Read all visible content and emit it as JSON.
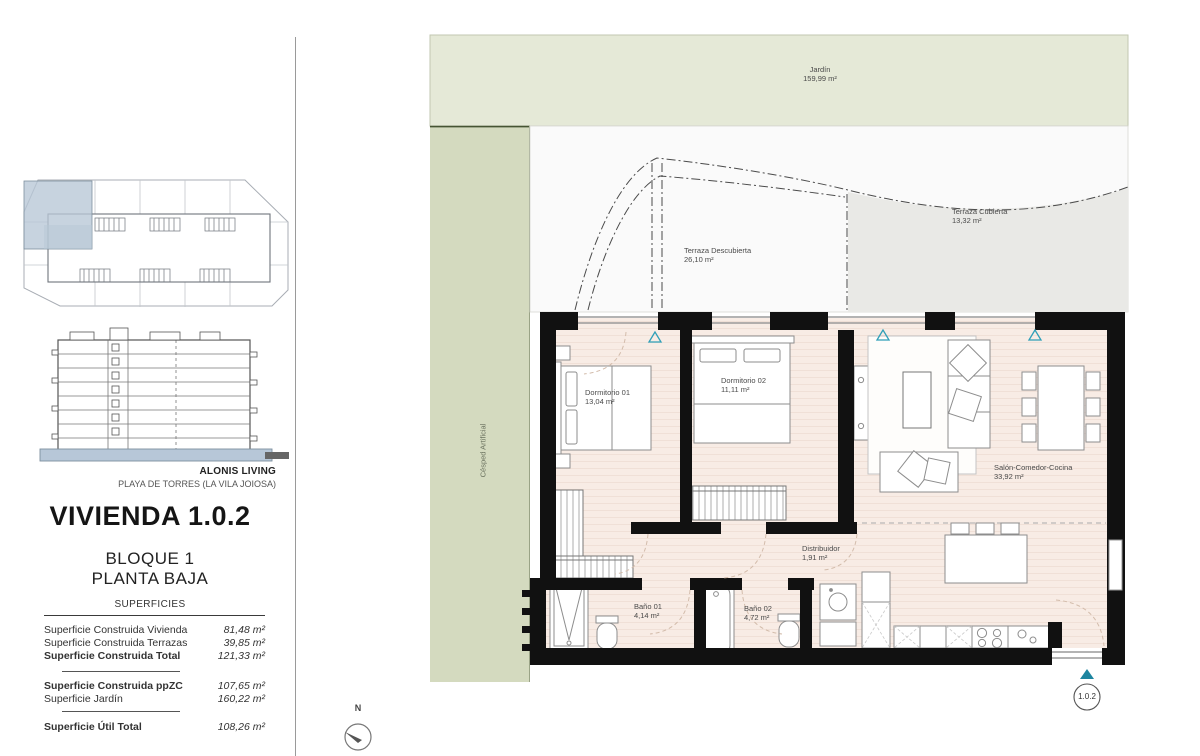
{
  "branding": {
    "name": "ALONIS LIVING",
    "location": "PLAYA DE TORRES (LA VILA JOIOSA)"
  },
  "unit": {
    "title": "VIVIENDA 1.0.2",
    "block": "BLOQUE 1",
    "floor": "PLANTA BAJA",
    "badge": "1.0.2"
  },
  "superficies": {
    "heading": "SUPERFICIES",
    "rows": [
      {
        "label": "Superficie Construida Vivienda",
        "value": "81,48 m²"
      },
      {
        "label": "Superficie Construida Terrazas",
        "value": "39,85 m²"
      },
      {
        "label": "Superficie Construida Total",
        "value": "121,33 m²"
      },
      {
        "label": "Superficie Construida ppZC",
        "value": "107,65 m²"
      },
      {
        "label": "Superficie Jardín",
        "value": "160,22 m²"
      },
      {
        "label": "Superficie Útil Total",
        "value": "108,26 m²"
      }
    ]
  },
  "plan": {
    "jardin": {
      "name": "Jardín",
      "area": "159,99 m²"
    },
    "cesped": {
      "name": "Césped Artificial"
    },
    "terraza_descubierta": {
      "name": "Terraza Descubierta",
      "area": "26,10 m²"
    },
    "terraza_cubierta": {
      "name": "Terraza Cubierta",
      "area": "13,32 m²"
    },
    "dormitorio_01": {
      "name": "Dormitorio 01",
      "area": "13,04 m²"
    },
    "dormitorio_02": {
      "name": "Dormitorio 02",
      "area": "11,11 m²"
    },
    "salon": {
      "name": "Salón-Comedor-Cocina",
      "area": "33,92 m²"
    },
    "distribuidor": {
      "name": "Distribuidor",
      "area": "1,91 m²"
    },
    "bano_01": {
      "name": "Baño 01",
      "area": "4,14 m²"
    },
    "bano_02": {
      "name": "Baño 02",
      "area": "4,72 m²"
    }
  },
  "compass": {
    "label": "N"
  },
  "colors": {
    "accent_teal": "#2f9fb8",
    "garden_green": "#e5e9d7",
    "grass_green": "#d4dabf",
    "floor_beige": "#f8ece5",
    "terrace_gray": "#e9e9e6",
    "wall_black": "#111111",
    "keyplan_blue": "#b7c7d6"
  }
}
